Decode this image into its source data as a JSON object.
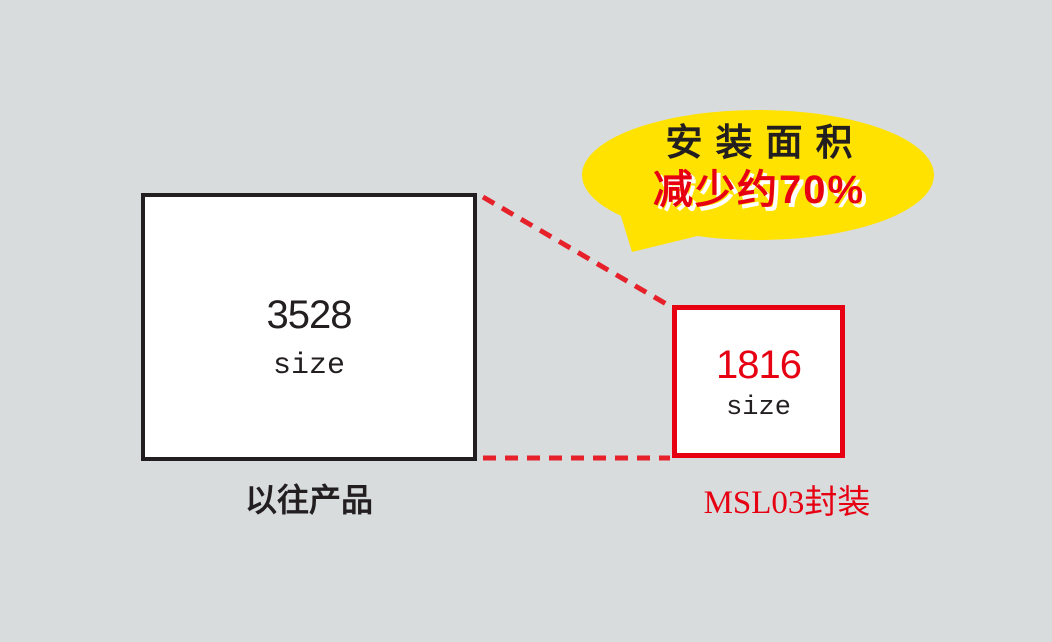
{
  "diagram": {
    "background_color": "#d8dcdd",
    "callout": {
      "line1": "安装面积",
      "line2": "减少约70%",
      "bubble_color": "#ffe200",
      "line1_color": "#231f20",
      "line2_color": "#e60012",
      "shadow_color": "#ffffff"
    },
    "previous_product": {
      "size_number": "3528",
      "size_label": "size",
      "caption": "以往产品",
      "border_color": "#231f20",
      "number_color": "#231f20"
    },
    "new_product": {
      "size_number": "1816",
      "size_label": "size",
      "caption": "MSL03封装",
      "border_color": "#e60012",
      "number_color": "#e60012"
    },
    "connector": {
      "color": "#e6212a",
      "style": "dashed"
    }
  }
}
